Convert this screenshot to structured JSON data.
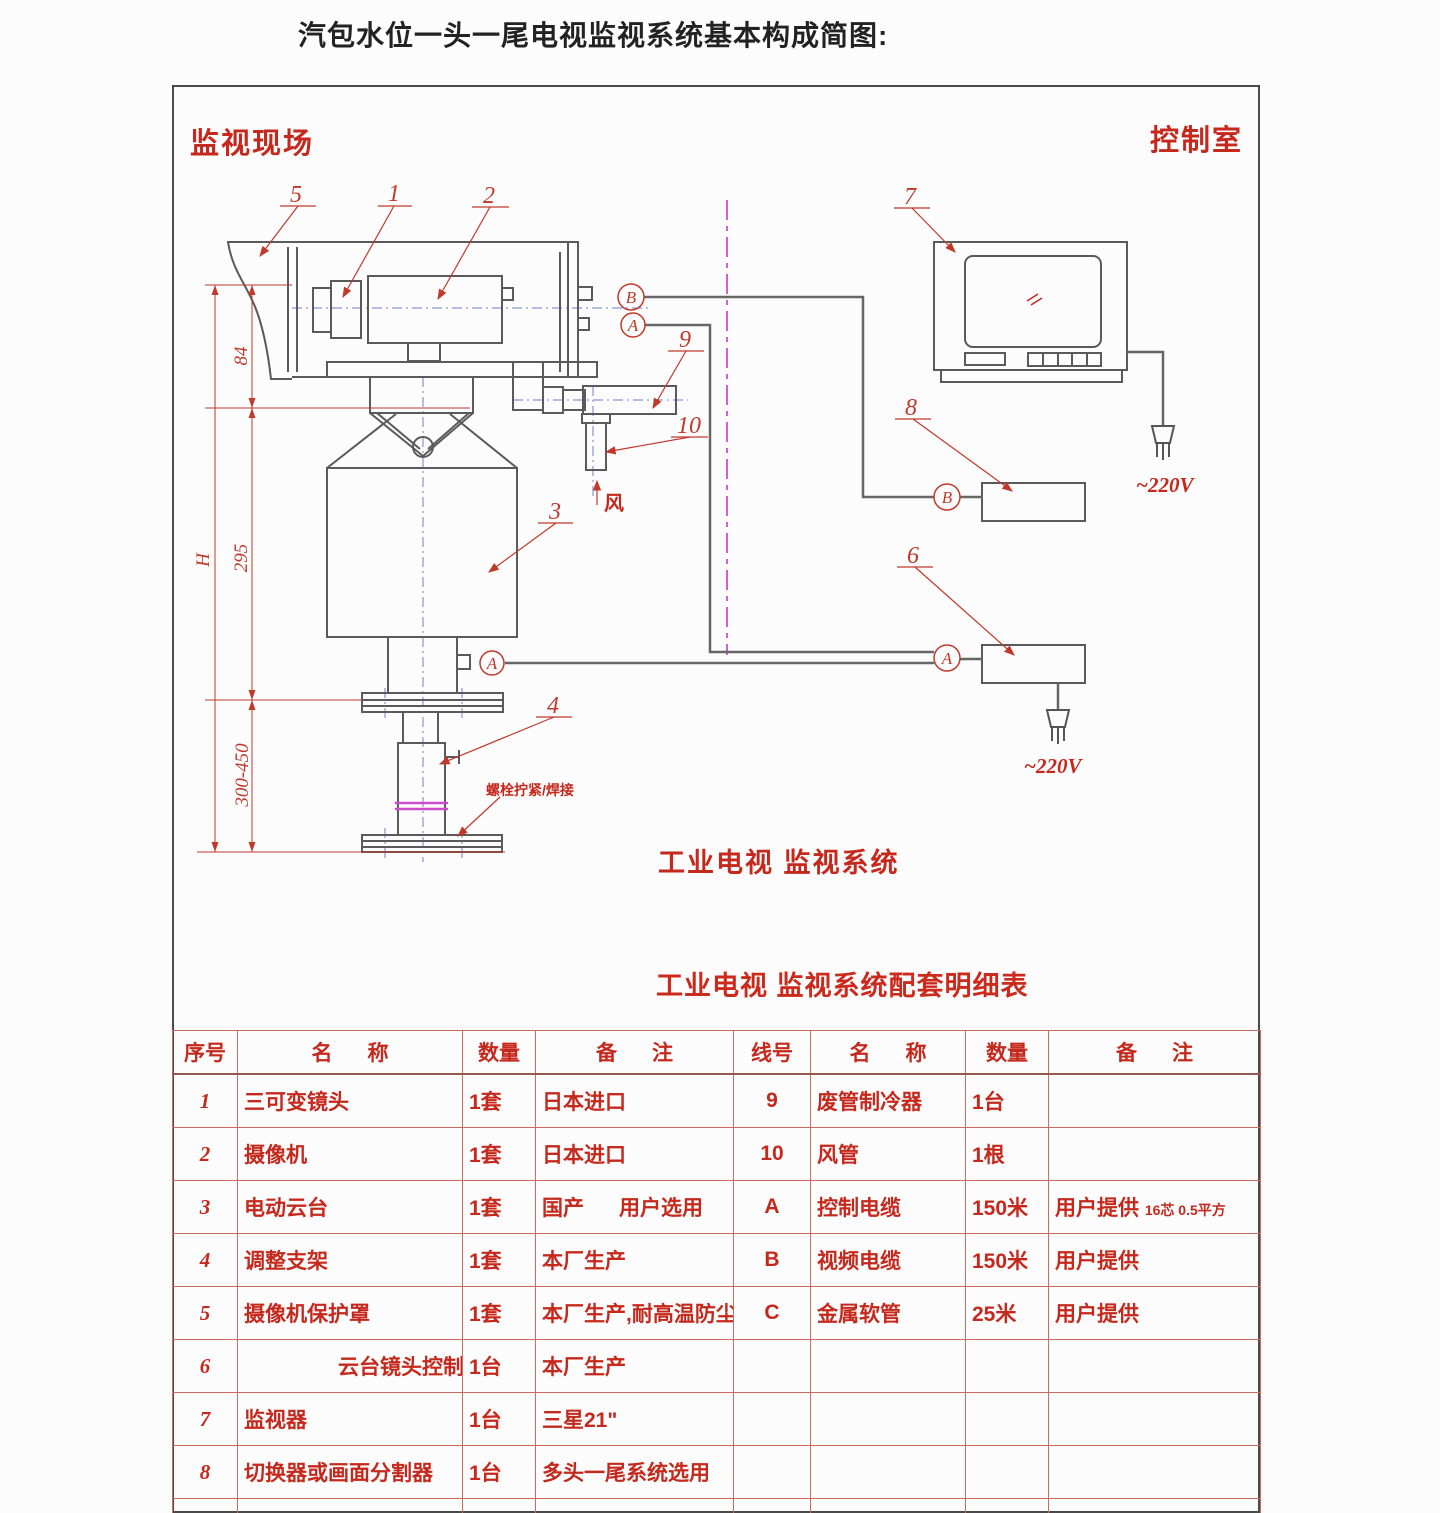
{
  "page": {
    "title": "汽包水位一头一尾电视监视系统基本构成简图:"
  },
  "diagram": {
    "site_label": "监视现场",
    "control_room_label": "控制室",
    "system_label": "工业电视 监视系统",
    "wind_label": "风",
    "weld_note": "螺栓拧紧/焊接",
    "voltage_monitor": "~220V",
    "voltage_controller": "~220V",
    "dim_h": "H",
    "dim_84": "84",
    "dim_295": "295",
    "dim_300_450": "300-450",
    "callouts": {
      "c1": "1",
      "c2": "2",
      "c3": "3",
      "c4": "4",
      "c5": "5",
      "c6": "6",
      "c7": "7",
      "c8": "8",
      "c9": "9",
      "c10": "10"
    },
    "connectors": {
      "a": "A",
      "b": "B"
    },
    "colors": {
      "accent_red": "#c5281c",
      "line_gray": "#5a5a5a",
      "centerline_blue": "#8a96d2",
      "centerline_magenta": "#d45fd4",
      "table_line_red": "#cb6a5e"
    }
  },
  "table": {
    "title": "工业电视 监视系统配套明细表",
    "headers": {
      "no": "序号",
      "name": "名      称",
      "qty": "数量",
      "remark": "备      注",
      "line": "线号",
      "name2": "名      称",
      "qty2": "数量",
      "remark2": "备      注"
    },
    "rows": [
      {
        "no": "1",
        "name": "三可变镜头",
        "qty": "1套",
        "remark": "日本进口",
        "line": "9",
        "name2": "废管制冷器",
        "qty2": "1台",
        "remark2": "",
        "remark2_small": ""
      },
      {
        "no": "2",
        "name": "摄像机",
        "qty": "1套",
        "remark": "日本进口",
        "line": "10",
        "name2": "风管",
        "qty2": "1根",
        "remark2": "",
        "remark2_small": ""
      },
      {
        "no": "3",
        "name": "电动云台",
        "qty": "1套",
        "remark": "国产      用户选用",
        "line": "A",
        "name2": "控制电缆",
        "qty2": "150米",
        "remark2": "用户提供",
        "remark2_small": "16芯 0.5平方"
      },
      {
        "no": "4",
        "name": "调整支架",
        "qty": "1套",
        "remark": "本厂生产",
        "line": "B",
        "name2": "视频电缆",
        "qty2": "150米",
        "remark2": "用户提供",
        "remark2_small": ""
      },
      {
        "no": "5",
        "name": "摄像机保护罩",
        "qty": "1套",
        "remark": "本厂生产,耐高温防尘",
        "line": "C",
        "name2": "金属软管",
        "qty2": "25米",
        "remark2": "用户提供",
        "remark2_small": ""
      },
      {
        "no": "6",
        "name": "云台镜头控制器",
        "qty": "1台",
        "remark": "本厂生产",
        "line": "",
        "name2": "",
        "qty2": "",
        "remark2": "",
        "remark2_small": ""
      },
      {
        "no": "7",
        "name": "监视器",
        "qty": "1台",
        "remark": "三星21\"",
        "line": "",
        "name2": "",
        "qty2": "",
        "remark2": "",
        "remark2_small": ""
      },
      {
        "no": "8",
        "name": "切换器或画面分割器",
        "qty": "1台",
        "remark": "多头一尾系统选用",
        "line": "",
        "name2": "",
        "qty2": "",
        "remark2": "",
        "remark2_small": ""
      }
    ]
  }
}
